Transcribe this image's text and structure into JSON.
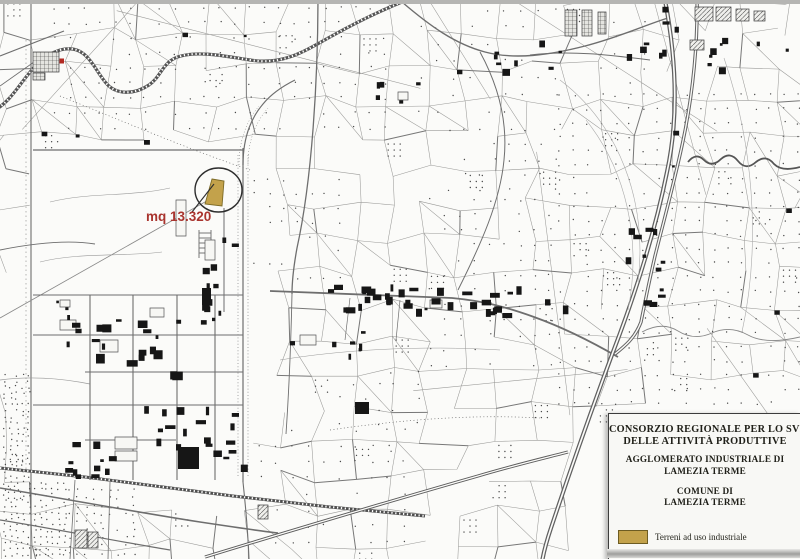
{
  "annotation": {
    "label": "mq 13.320"
  },
  "title_box": {
    "org_line1": "CONSORZIO REGIONALE PER LO SVILUPPO",
    "org_line2": "DELLE ATTIVITÀ PRODUTTIVE",
    "agglomerato_line1": "AGGLOMERATO INDUSTRIALE DI",
    "agglomerato_line2": "LAMEZIA TERME",
    "comune_line1": "COMUNE DI",
    "comune_line2": "LAMEZIA TERME",
    "legend": {
      "label": "Terreni ad uso industriale"
    }
  },
  "colors": {
    "highlight": "#c3a24b",
    "highlight_border": "#7c6a26",
    "annotation_red": "#a9342e"
  }
}
